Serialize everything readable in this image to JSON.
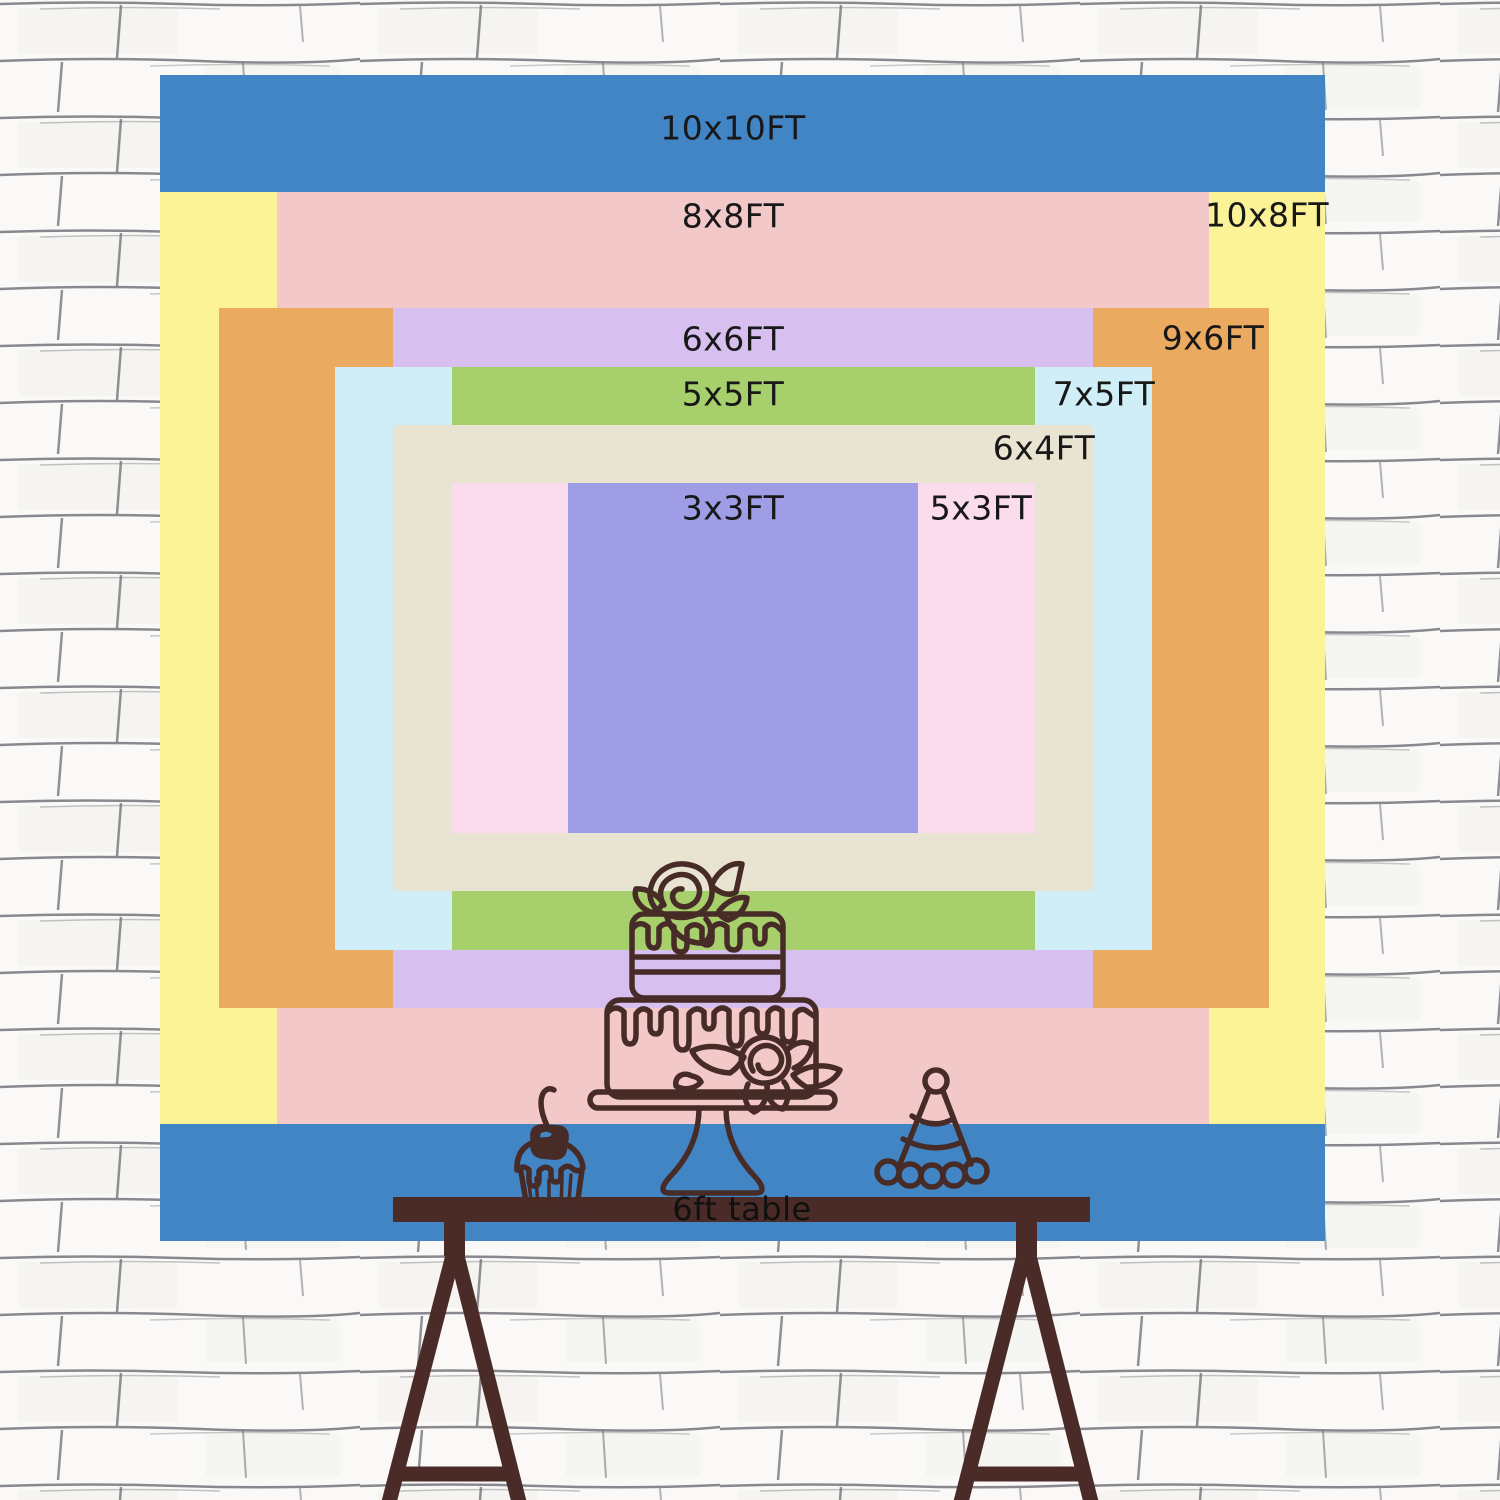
{
  "chart": {
    "type": "nested-size-diagram",
    "unit": "FT",
    "sizes": [
      {
        "id": "10x10",
        "label": "10x10FT",
        "width_ft": 10,
        "height_ft": 10,
        "color": "#4285c5"
      },
      {
        "id": "10x8",
        "label": "10x8FT",
        "width_ft": 10,
        "height_ft": 8,
        "color": "#fcf399"
      },
      {
        "id": "8x8",
        "label": "8x8FT",
        "width_ft": 8,
        "height_ft": 8,
        "color": "#f3c8c9"
      },
      {
        "id": "9x6",
        "label": "9x6FT",
        "width_ft": 9,
        "height_ft": 6,
        "color": "#eaab60"
      },
      {
        "id": "6x6",
        "label": "6x6FT",
        "width_ft": 6,
        "height_ft": 6,
        "color": "#d7bfef"
      },
      {
        "id": "7x5",
        "label": "7x5FT",
        "width_ft": 7,
        "height_ft": 5,
        "color": "#cfeef8"
      },
      {
        "id": "5x5",
        "label": "5x5FT",
        "width_ft": 5,
        "height_ft": 5,
        "color": "#a7d06c"
      },
      {
        "id": "6x4",
        "label": "6x4FT",
        "width_ft": 6,
        "height_ft": 4,
        "color": "#e9e4d2"
      },
      {
        "id": "5x3",
        "label": "5x3FT",
        "width_ft": 5,
        "height_ft": 3,
        "color": "#fbdcec"
      },
      {
        "id": "3x3",
        "label": "3x3FT",
        "width_ft": 3,
        "height_ft": 3,
        "color": "#9e9de6"
      }
    ]
  },
  "table": {
    "label": "6ft table",
    "color": "#4a2b27"
  },
  "decorations": {
    "cupcake": "cupcake-icon",
    "cake": "tiered-cake-icon",
    "hat": "party-hat-icon",
    "line_color": "#472b27"
  },
  "wall": {
    "style": "white-brick",
    "line_color": "#6d6c74",
    "background": "#faf9f7"
  }
}
